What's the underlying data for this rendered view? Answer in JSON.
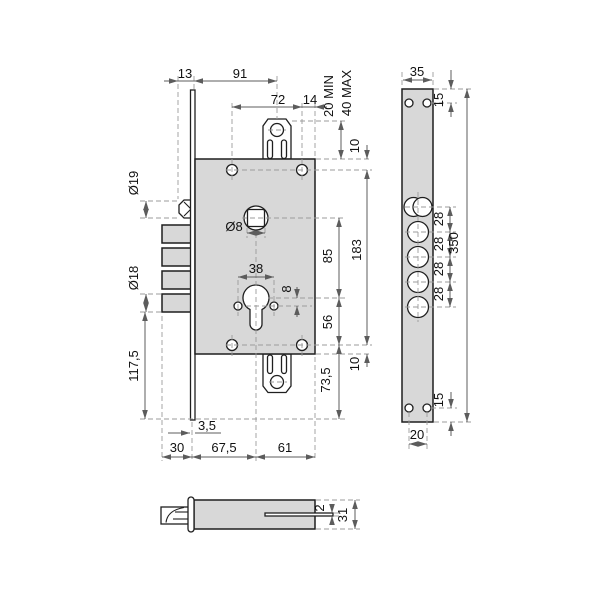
{
  "colors": {
    "outline": "#1f1f1f",
    "part_fill": "#d8d8d8",
    "hole_fill": "#ffffff",
    "dim_line": "#5c5c5c",
    "ext_line": "#9b9b9b",
    "text": "#111111",
    "bg": "#ffffff"
  },
  "dims": {
    "d13": "13",
    "d91": "91",
    "d72": "72",
    "d14": "14",
    "min20": "20 MIN",
    "max40": "40 MAX",
    "d10_top": "10",
    "d183": "183",
    "d85": "85",
    "d56": "56",
    "d73_5": "73,5",
    "d10_bottom": "10",
    "dia19": "Ø19",
    "dia18": "Ø18",
    "d117_5": "117,5",
    "dia8": "Ø8",
    "d38": "38",
    "d8": "8",
    "d3_5": "3,5",
    "d30": "30",
    "d67_5": "67,5",
    "d61": "61",
    "d35": "35",
    "d15_top": "15",
    "d28": [
      "28",
      "28",
      "28",
      "28"
    ],
    "d350": "350",
    "d15_bottom": "15",
    "d20": "20",
    "d2": "2",
    "d31": "31"
  }
}
